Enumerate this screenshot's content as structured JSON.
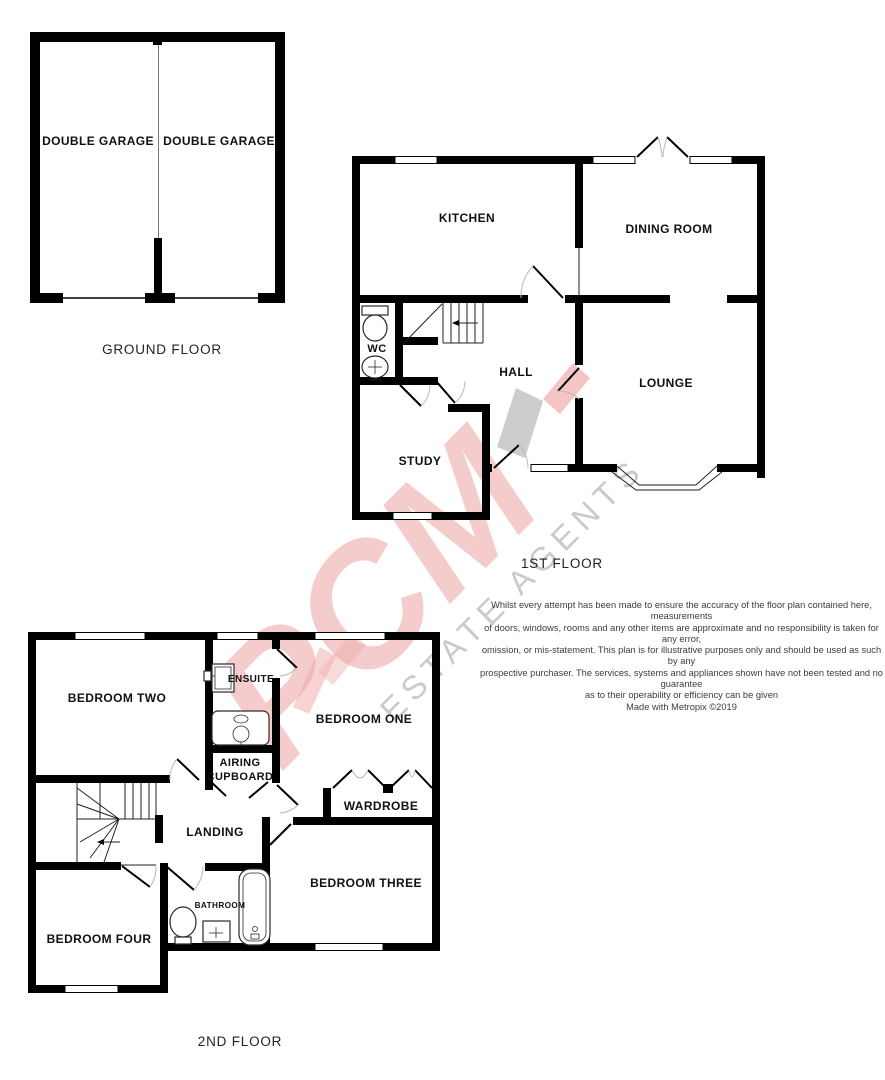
{
  "watermark": {
    "brand": "PCM",
    "tagline": "ESTATE AGENTS",
    "brand_color": "#eda4a4",
    "tagline_color": "#9f9f9f"
  },
  "floors": {
    "ground": {
      "label": "GROUND FLOOR",
      "rooms": {
        "garage_left": "DOUBLE GARAGE",
        "garage_right": "DOUBLE GARAGE"
      }
    },
    "first": {
      "label": "1ST FLOOR",
      "rooms": {
        "kitchen": "KITCHEN",
        "dining_room": "DINING ROOM",
        "wc": "WC",
        "hall": "HALL",
        "lounge": "LOUNGE",
        "study": "STUDY"
      }
    },
    "second": {
      "label": "2ND FLOOR",
      "rooms": {
        "bedroom_two": "BEDROOM TWO",
        "ensuite": "ENSUITE",
        "bedroom_one": "BEDROOM ONE",
        "airing_cupboard_line1": "AIRING",
        "airing_cupboard_line2": "CUPBOARD",
        "wardrobe": "WARDROBE",
        "landing": "LANDING",
        "bedroom_three": "BEDROOM THREE",
        "bathroom": "BATHROOM",
        "bedroom_four": "BEDROOM FOUR"
      }
    }
  },
  "disclaimer": {
    "lines": [
      "Whilst every attempt has been made to ensure the accuracy of the floor plan contained here, measurements",
      "of doors, windows, rooms and any other items are approximate and no responsibility is taken for any error,",
      "omission, or mis-statement. This plan is for illustrative purposes only and should be used as such by any",
      "prospective purchaser. The services, systems and appliances shown have not been tested and no guarantee",
      "as to their operability or efficiency can be given",
      "Made with Metropix ©2019"
    ]
  }
}
